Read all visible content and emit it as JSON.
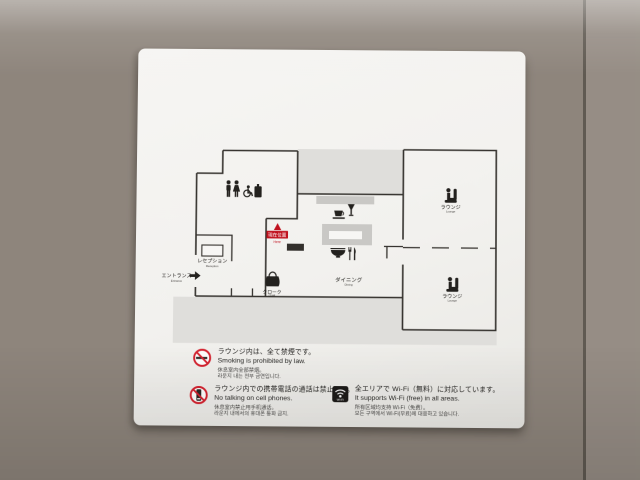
{
  "sign": {
    "map": {
      "marker": {
        "jp": "現在位置",
        "en": "Here"
      },
      "labels": {
        "entrance": {
          "jp": "エントランス",
          "en": "Entrance"
        },
        "reception": {
          "jp": "レセプション",
          "en": "Reception"
        },
        "cloak": {
          "jp": "クローク",
          "en": "Cloak"
        },
        "dining": {
          "jp": "ダイニング",
          "en": "Dining"
        },
        "lounge_upper": {
          "jp": "ラウンジ",
          "en": "Lounge"
        },
        "lounge_lower": {
          "jp": "ラウンジ",
          "en": "Lounge"
        }
      }
    },
    "notices": {
      "smoking": {
        "jp": "ラウンジ内は、全て禁煙です。",
        "en": "Smoking is prohibited by law.",
        "zh": "休息室内全部禁烟。",
        "ko": "라운지 내는 전부 금연입니다."
      },
      "phone": {
        "jp": "ラウンジ内での携帯電話の通話は禁止です。",
        "en": "No talking on cell phones.",
        "zh": "休息室内禁止用手机通话。",
        "ko": "라운지 내에서의 휴대폰 통화 금지."
      },
      "wifi": {
        "icon_label": "Wi-Fi",
        "jp": "全エリアで Wi-Fi（無料）に対応しています。",
        "en": "It supports Wi-Fi (free) in all areas.",
        "zh": "所有区域均支持 Wi-Fi（免费）。",
        "ko": "모든 구역에서 Wi-Fi(무료)에 대응하고 있습니다."
      }
    },
    "colors": {
      "marker_red": "#c0121e",
      "prohibition_red": "#d42330",
      "wall_black": "#35322e"
    }
  }
}
